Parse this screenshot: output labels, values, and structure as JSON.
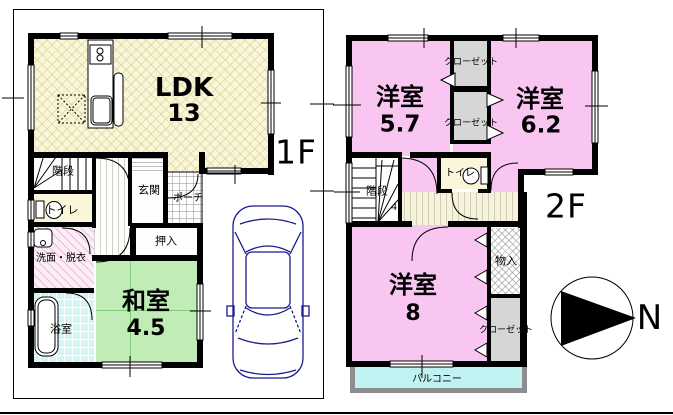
{
  "floor1": {
    "floor_label": "1F",
    "rooms": {
      "ldk": {
        "name": "LDK",
        "size": "13"
      },
      "stairs": {
        "name": "階段"
      },
      "toilet": {
        "name": "トイレ"
      },
      "entrance": {
        "name": "玄関"
      },
      "porch": {
        "name": "ポーチ"
      },
      "washroom": {
        "name": "洗面・脱衣"
      },
      "bathroom": {
        "name": "浴室"
      },
      "futon_closet": {
        "name": "押入"
      },
      "japanese_room": {
        "name": "和室",
        "size": "4.5"
      }
    }
  },
  "floor2": {
    "floor_label": "2F",
    "rooms": {
      "western_room_1": {
        "name": "洋室",
        "size": "5.7"
      },
      "western_room_2": {
        "name": "洋室",
        "size": "6.2"
      },
      "western_room_3": {
        "name": "洋室",
        "size": "8"
      },
      "closet_top": {
        "name": "クローゼット"
      },
      "closet_mid": {
        "name": "クローゼット"
      },
      "closet_bottom": {
        "name": "クローゼット"
      },
      "storage": {
        "name": "物入"
      },
      "stairs": {
        "name": "階段",
        "note": "4"
      },
      "toilet": {
        "name": "トイレ"
      },
      "balcony": {
        "name": "バルコニー"
      }
    }
  },
  "compass": {
    "north_label": "N"
  },
  "colors": {
    "western_room_pink": "#F8C6F0",
    "japanese_room_green": "#BFEDB5",
    "ldk_cream": "#FAF6D8",
    "toilet_cream": "#FAF6D9",
    "closet_gray": "#D6D6D6",
    "bath_tile_cyan": "#D7F4F2",
    "balcony_cyan": "#BFF2F0",
    "balcony_border_gray": "#8E8E8E",
    "car_outline_navy": "#1B1B8F",
    "wall_black": "#000000"
  }
}
